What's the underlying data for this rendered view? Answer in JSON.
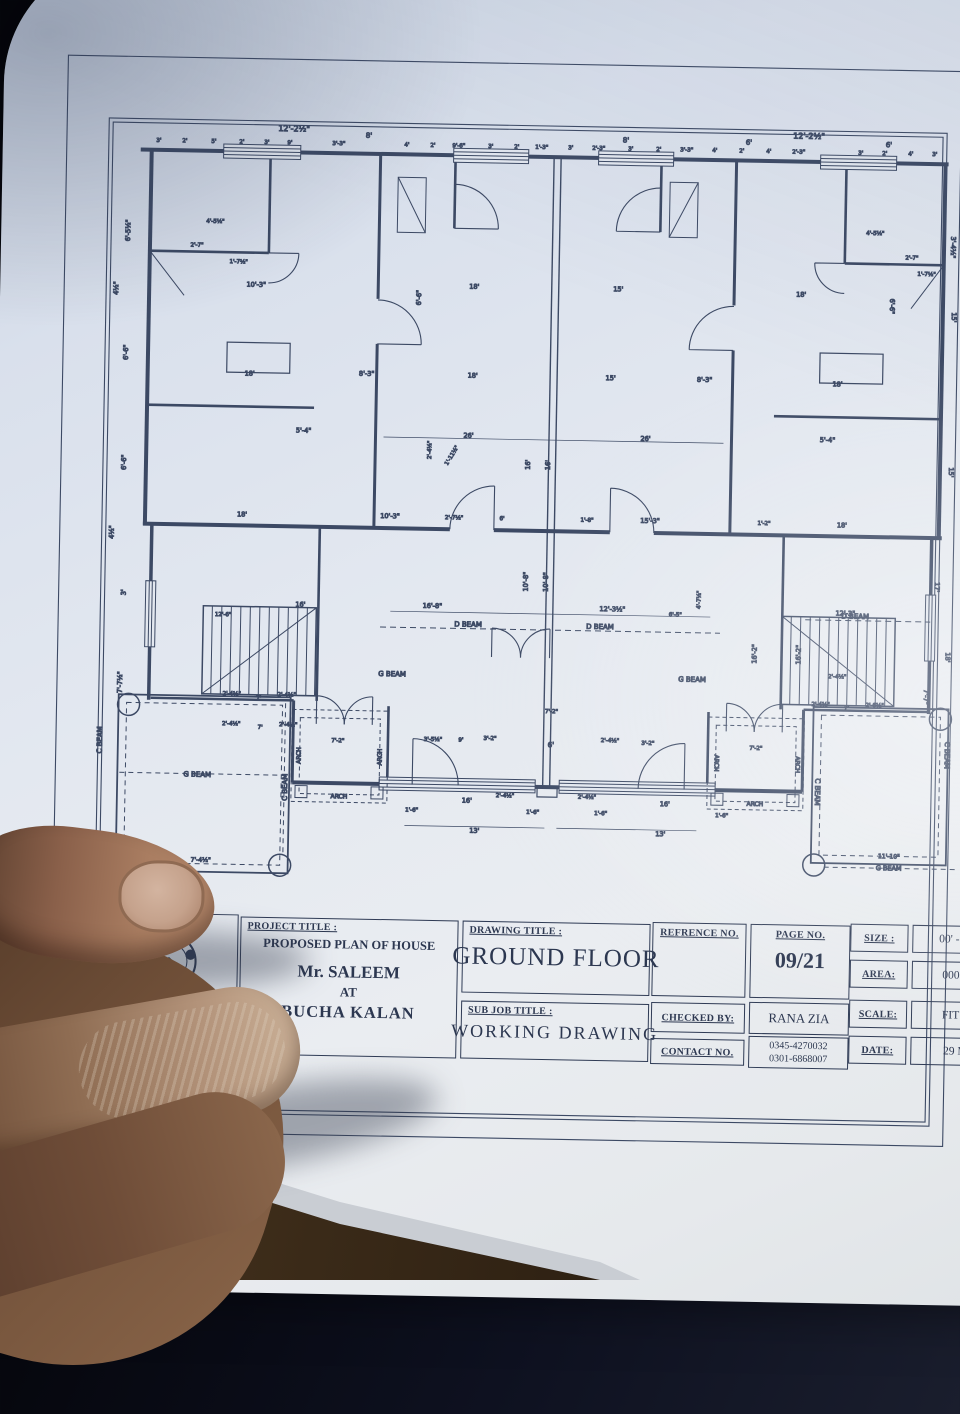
{
  "colors": {
    "paper": "#e6eaf0",
    "ink": "#2f3b55",
    "plan_line": "#46536f",
    "skin": "#a97d61",
    "wood": "#3a2a18"
  },
  "title_block": {
    "designed_by_label": "DESIGNED BY :",
    "firm_name": "ITTIHAD-ASSOCIATES",
    "project_title_label": "PROJECT TITLE :",
    "project_lines": [
      "PROPOSED PLAN OF HOUSE",
      "Mr. SALEEM",
      "AT",
      "BUCHA KALAN"
    ],
    "drawing_title_label": "DRAWING TITLE :",
    "drawing_title": "GROUND FLOOR",
    "sub_job_title_label": "SUB JOB TITLE :",
    "sub_job_title": "WORKING  DRAWING",
    "refrence_no_label": "REFRENCE NO.",
    "page_no_label": "PAGE NO.",
    "page_no": "09/21",
    "checked_by_label": "CHECKED BY:",
    "checked_by": "RANA ZIA",
    "contact_no_label": "CONTACT NO.",
    "contact_numbers": [
      "0345-4270032",
      "0301-6868007"
    ],
    "size_label": "SIZE :",
    "size_value": "00' - 0''x00'",
    "area_label": "AREA:",
    "area_value": "000 S.F.T",
    "scale_label": "SCALE:",
    "scale_value": "FIT TO S",
    "date_label": "DATE:",
    "date_value": "29 MAR"
  },
  "plan": {
    "labels": [
      [
        285,
        136,
        "12'-2½\"",
        0,
        8
      ],
      [
        800,
        134,
        "12'-2½\"",
        0,
        8
      ],
      [
        360,
        141,
        "8'",
        0,
        7
      ],
      [
        617,
        141,
        "8'",
        0,
        7
      ],
      [
        740,
        141,
        "6'",
        0,
        7
      ],
      [
        880,
        141,
        "6'",
        0,
        7
      ],
      [
        150,
        149,
        "3'",
        0,
        5.5
      ],
      [
        176,
        149,
        "2'",
        0,
        5.5
      ],
      [
        205,
        149,
        "5'",
        0,
        5.5
      ],
      [
        233,
        149,
        "2'",
        0,
        5.5
      ],
      [
        258,
        149,
        "3'",
        0,
        5.5
      ],
      [
        281,
        149,
        "9'",
        0,
        5.5
      ],
      [
        330,
        149,
        "3'-3\"",
        0,
        5.5
      ],
      [
        398,
        149,
        "4'",
        0,
        5.5
      ],
      [
        424,
        149,
        "2'",
        0,
        5.5
      ],
      [
        450,
        149,
        "9'-6\"",
        0,
        5.5
      ],
      [
        482,
        149,
        "3'",
        0,
        5.5
      ],
      [
        508,
        149,
        "2'",
        0,
        5.5
      ],
      [
        533,
        149,
        "1'-3\"",
        0,
        5.5
      ],
      [
        562,
        149,
        "3'",
        0,
        5.5
      ],
      [
        590,
        149,
        "2'-3\"",
        0,
        5.5
      ],
      [
        622,
        149,
        "3'",
        0,
        5.5
      ],
      [
        650,
        149,
        "2'",
        0,
        5.5
      ],
      [
        678,
        149,
        "3'-3\"",
        0,
        5.5
      ],
      [
        706,
        149,
        "4'",
        0,
        5.5
      ],
      [
        733,
        149,
        "2'",
        0,
        5.5
      ],
      [
        760,
        149,
        "4'",
        0,
        5.5
      ],
      [
        790,
        149,
        "2'-3\"",
        0,
        5.5
      ],
      [
        852,
        149,
        "3'",
        0,
        5.5
      ],
      [
        876,
        149,
        "2'",
        0,
        5.5
      ],
      [
        902,
        149,
        "4'",
        0,
        5.5
      ],
      [
        926,
        149,
        "3'",
        0,
        5.5
      ],
      [
        123,
        238,
        "6'-5½\"",
        -90
      ],
      [
        112,
        296,
        "4½\"",
        -90
      ],
      [
        123,
        360,
        "6'-6\"",
        -90
      ],
      [
        123,
        470,
        "6'-6\"",
        -90
      ],
      [
        112,
        540,
        "4½\"",
        -90
      ],
      [
        125,
        600,
        "3'",
        -90
      ],
      [
        123,
        690,
        "7'-7½\"",
        -90
      ],
      [
        944,
        240,
        "3'-4½\"",
        90
      ],
      [
        946,
        310,
        "15'",
        90
      ],
      [
        946,
        465,
        "15'",
        90
      ],
      [
        934,
        580,
        "17'",
        90
      ],
      [
        946,
        650,
        "18'",
        90
      ],
      [
        925,
        690,
        "7'-7\"",
        90
      ],
      [
        250,
        292,
        "10'-3\""
      ],
      [
        468,
        290,
        "18'"
      ],
      [
        612,
        290,
        "15'"
      ],
      [
        795,
        292,
        "18'"
      ],
      [
        245,
        381,
        "18'"
      ],
      [
        362,
        379,
        "8'-3\""
      ],
      [
        468,
        379,
        "18'"
      ],
      [
        606,
        379,
        "15'"
      ],
      [
        700,
        379,
        "8'-3\""
      ],
      [
        833,
        381,
        "18'"
      ],
      [
        300,
        437,
        "5'-4\""
      ],
      [
        465,
        439,
        "26'"
      ],
      [
        642,
        439,
        "26'"
      ],
      [
        824,
        437,
        "5'-4\""
      ],
      [
        527,
        465,
        "16'",
        -90
      ],
      [
        547,
        465,
        "16'",
        -90
      ],
      [
        527,
        582,
        "10'-8\"",
        -90
      ],
      [
        547,
        582,
        "10'-8\"",
        -90
      ],
      [
        757,
        650,
        "16'-2\"",
        -90
      ],
      [
        801,
        650,
        "16'-2\"",
        -90
      ],
      [
        240,
        522,
        "18'"
      ],
      [
        388,
        521,
        "10'-3\""
      ],
      [
        452,
        521,
        "2'-7½\"",
        0,
        5.5
      ],
      [
        500,
        521,
        "6'",
        0,
        5.5
      ],
      [
        585,
        521,
        "1'-8\"",
        0,
        5.5
      ],
      [
        648,
        521,
        "15'-3\""
      ],
      [
        762,
        521,
        "1'-2\"",
        0,
        5.5
      ],
      [
        840,
        522,
        "18'"
      ],
      [
        300,
        611,
        "16'"
      ],
      [
        432,
        610,
        "16'-8\""
      ],
      [
        612,
        610,
        "12'-3½\""
      ],
      [
        845,
        610,
        "12'-3\""
      ],
      [
        223,
        622,
        "12'-6\"",
        0,
        5.5
      ],
      [
        675,
        614,
        "6'-5\"",
        0,
        5.5
      ],
      [
        468,
        628,
        "D BEAM",
        0,
        7
      ],
      [
        600,
        628,
        "D BEAM",
        0,
        7
      ],
      [
        855,
        613,
        "D BEAM",
        0,
        7
      ],
      [
        393,
        679,
        "G BEAM",
        0,
        7
      ],
      [
        693,
        679,
        "G BEAM",
        0,
        7
      ],
      [
        200,
        783,
        "G BEAM",
        0,
        7
      ],
      [
        893,
        864,
        "G BEAM",
        0,
        6.5
      ],
      [
        893,
        852,
        "11'-10\"",
        0,
        6
      ],
      [
        205,
        868,
        "7'-4½\"",
        0,
        6
      ],
      [
        104,
        748,
        "C BEAM",
        -90,
        7
      ],
      [
        290,
        792,
        "C BEAM",
        -90,
        7
      ],
      [
        818,
        787,
        "C BEAM",
        90,
        7
      ],
      [
        947,
        748,
        "C BEAM",
        90,
        7
      ],
      [
        303,
        760,
        "ARCH",
        -90,
        6
      ],
      [
        384,
        760,
        "ARCH",
        -90,
        6
      ],
      [
        342,
        802,
        "ARCH",
        0,
        6
      ],
      [
        717,
        760,
        "ARCH",
        90,
        6
      ],
      [
        798,
        760,
        "ARCH",
        90,
        6
      ],
      [
        758,
        802,
        "ARCH",
        0,
        6
      ],
      [
        233,
        701,
        "2'-4½\"",
        0,
        5.5
      ],
      [
        260,
        705,
        "7'",
        0,
        5.5
      ],
      [
        288,
        701,
        "2'-4½\"",
        0,
        5.5
      ],
      [
        233,
        731,
        "2'-4½\"",
        0,
        5.5
      ],
      [
        262,
        734,
        "7'",
        0,
        5.5
      ],
      [
        290,
        731,
        "2'-4½\"",
        0,
        5.5
      ],
      [
        822,
        701,
        "2'-4½\"",
        0,
        5.5
      ],
      [
        848,
        704,
        "7'",
        0,
        5.5
      ],
      [
        876,
        701,
        "2'-6½\"",
        0,
        5.5
      ],
      [
        838,
        673,
        "2'-4½\"",
        0,
        5.5
      ],
      [
        435,
        743,
        "3'-5½\"",
        0,
        5.5
      ],
      [
        463,
        743,
        "9'",
        0,
        5.5
      ],
      [
        492,
        741,
        "3'-2\"",
        0,
        5.5
      ],
      [
        553,
        747,
        "6'",
        0,
        7
      ],
      [
        612,
        741,
        "2'-4½\"",
        0,
        5.5
      ],
      [
        650,
        743,
        "3'-2\"",
        0,
        5.5
      ],
      [
        553,
        713,
        "7'-2\"",
        0,
        5.5
      ],
      [
        340,
        746,
        "7'-2\"",
        0,
        5.5
      ],
      [
        758,
        746,
        "7'-2\"",
        0,
        5.5
      ],
      [
        470,
        804,
        "16'"
      ],
      [
        668,
        804,
        "16'"
      ],
      [
        508,
        798,
        "2'-4½\"",
        0,
        5.5
      ],
      [
        590,
        798,
        "2'-4½\"",
        0,
        5.5
      ],
      [
        415,
        814,
        "1'-6\"",
        0,
        5.5
      ],
      [
        536,
        814,
        "1'-6\"",
        0,
        5.5
      ],
      [
        604,
        814,
        "1'-6\"",
        0,
        5.5
      ],
      [
        725,
        814,
        "1'-6\"",
        0,
        5.5
      ],
      [
        478,
        834,
        "13'"
      ],
      [
        664,
        834,
        "13'"
      ],
      [
        208,
        229,
        "4'-5½\"",
        0,
        5.5
      ],
      [
        190,
        253,
        "2'-7\"",
        0,
        5.5
      ],
      [
        232,
        269,
        "1'-7½\"",
        0,
        5.5
      ],
      [
        868,
        229,
        "4'-5½\"",
        0,
        5.5
      ],
      [
        905,
        253,
        "2'-7\"",
        0,
        5.5
      ],
      [
        920,
        269,
        "1'-7½\"",
        0,
        5.5
      ],
      [
        415,
        300,
        "6'-6\"",
        -90
      ],
      [
        428,
        452,
        "2'-4½\"",
        -90,
        5.5
      ],
      [
        450,
        458,
        "1'-11½\"",
        -60,
        5.5
      ],
      [
        884,
        300,
        "6'-6\"",
        90
      ],
      [
        700,
        597,
        "4'-7½\"",
        -90,
        5.5
      ]
    ]
  }
}
